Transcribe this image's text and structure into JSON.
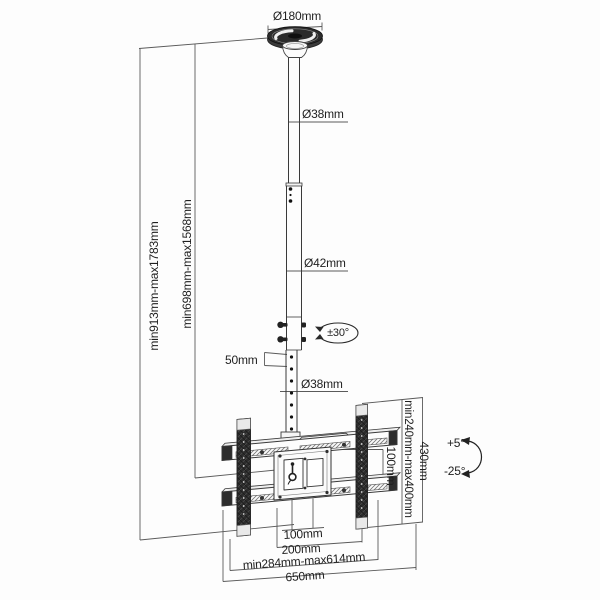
{
  "diagram": {
    "type": "technical-drawing",
    "subject": "ceiling TV mount dimension drawing",
    "ceiling_plate": {
      "diameter": "Ø180mm"
    },
    "pole": {
      "upper_diameter": "Ø38mm",
      "middle_diameter": "Ø42mm",
      "lower_diameter": "Ø38mm",
      "hole_spacing": "50mm",
      "swivel": "±30°"
    },
    "height": {
      "overall": "min913mm-max1783mm",
      "to_bracket": "min698mm-max1568mm"
    },
    "bracket": {
      "vesa_vertical": "100mm",
      "vertical_range": "min240mm-max400mm",
      "rail_height": "430mm",
      "tilt_up": "+5°",
      "tilt_down": "-25°",
      "vesa_horizontal": "100mm",
      "vesa_horizontal_outer": "200mm",
      "width_range": "min284mm-max614mm",
      "overall_width": "650mm"
    },
    "colors": {
      "line": "#3a3a3a",
      "dim_line": "#5a5a5a",
      "dark_fill": "#2d2d2d",
      "text": "#1f1f1f",
      "background": "#ffffff"
    }
  }
}
